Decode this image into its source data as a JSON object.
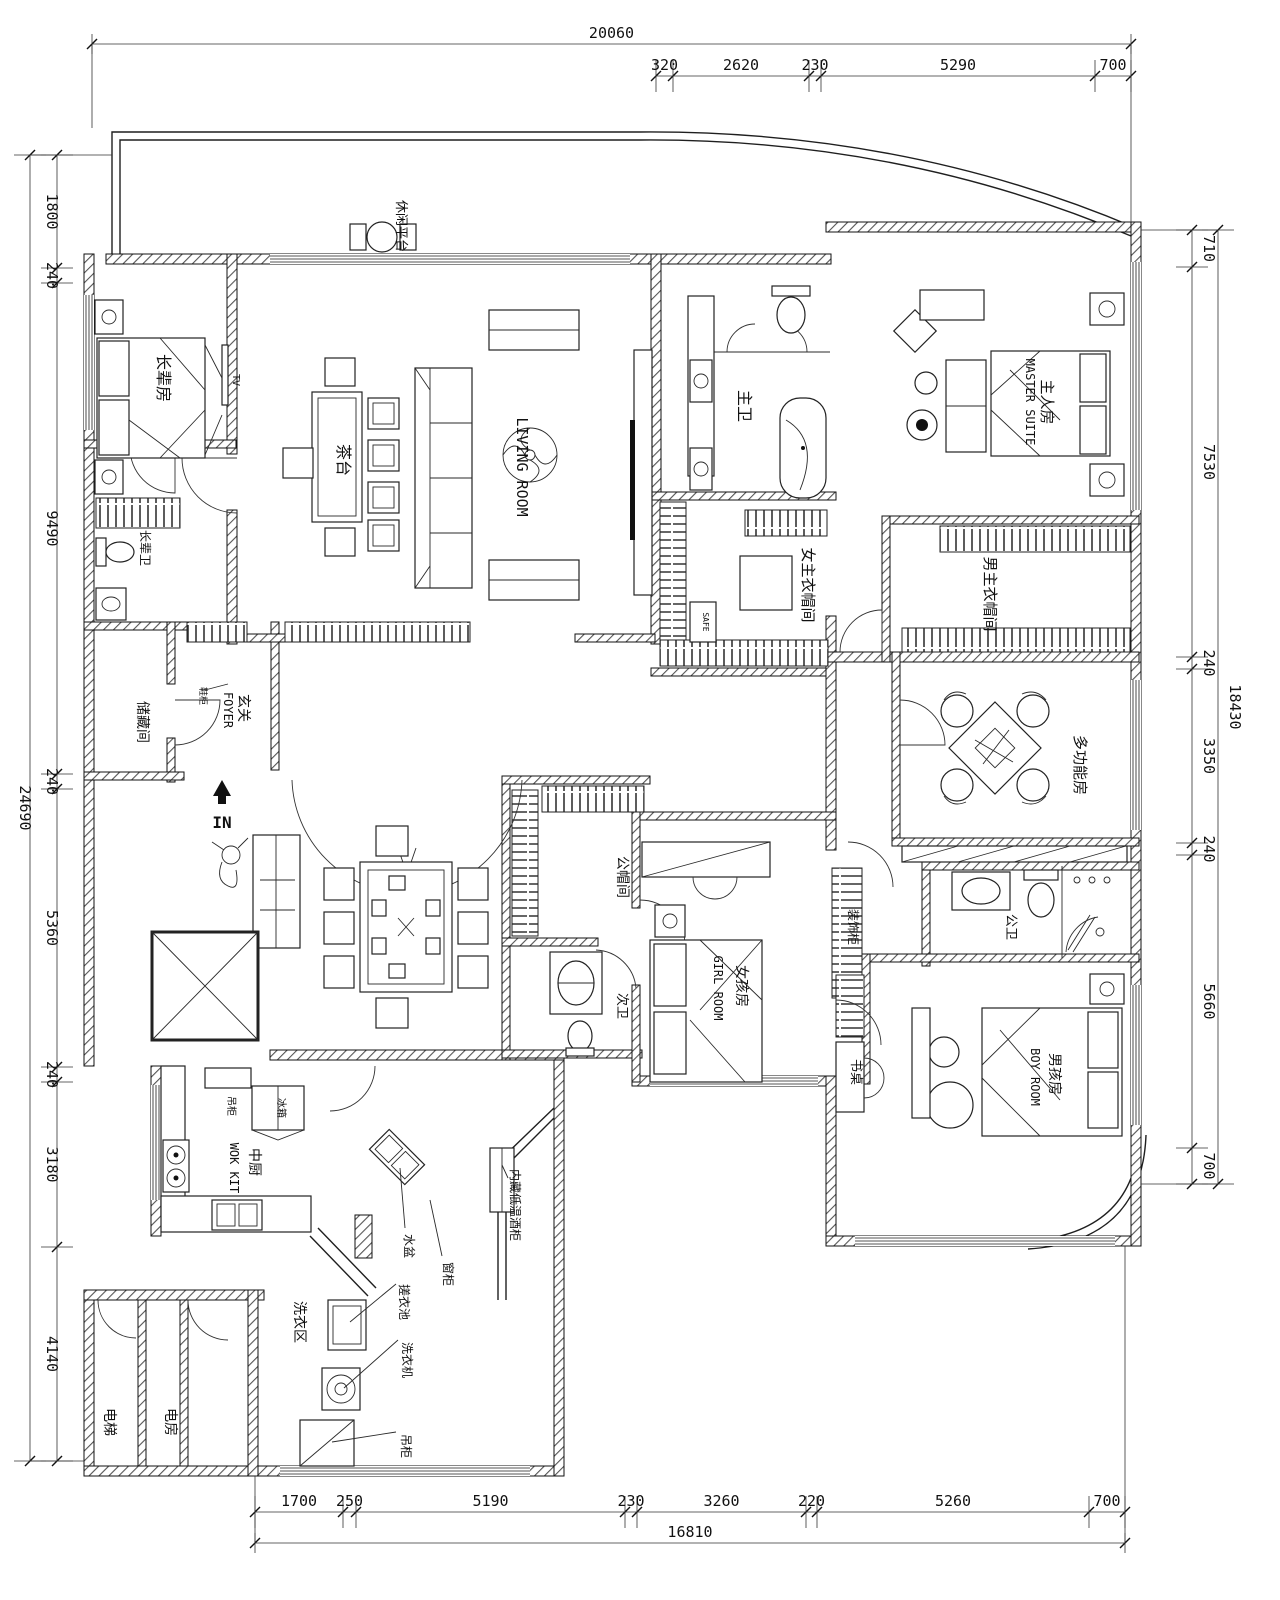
{
  "drawing": {
    "type": "residential-floor-plan"
  },
  "dimensions": {
    "top": {
      "overall": "20060",
      "segments": [
        "320",
        "2620",
        "230",
        "5290",
        "700"
      ]
    },
    "bottom": {
      "overall": "16810",
      "segments": [
        "1700",
        "250",
        "5190",
        "230",
        "3260",
        "220",
        "5260",
        "700"
      ]
    },
    "left": {
      "overall": "24690",
      "segments": [
        "1800",
        "240",
        "9490",
        "240",
        "5360",
        "240",
        "3180",
        "4140"
      ]
    },
    "right": {
      "overall": "18430",
      "segments": [
        "710",
        "7530",
        "240",
        "3350",
        "240",
        "5660",
        "700"
      ]
    }
  },
  "rooms": {
    "balcony": "休闲平台",
    "elder": "长辈房",
    "elder_bath": "长辈卫",
    "storage": "储藏间",
    "foyer_zh": "玄关",
    "foyer_en": "FOYER",
    "shoe_cabinet": "鞋柜",
    "living_en": "LIVING ROOM",
    "tea_table": "茶台",
    "master_bath": "主卫",
    "master_zh": "主人房",
    "master_en": "MASTER SUITE",
    "female_closet": "女主衣帽间",
    "male_closet": "男主衣帽间",
    "multi_room": "多功能房",
    "cloak_room": "公帽间",
    "girl_bath": "次卫",
    "girl_zh": "女孩房",
    "girl_en": "GIRL ROOM",
    "public_bath": "公卫",
    "deco_cabinet": "装饰柜",
    "desk": "书桌",
    "boy_zh": "男孩房",
    "boy_en": "BOY ROOM",
    "wok_zh": "中厨",
    "wok_en": "WOK KIT",
    "hanging_cabinet_kitchen": "吊柜",
    "fridge": "冰箱",
    "laundry": "洗衣区",
    "basin": "水盆",
    "window_cabinet": "窗柜",
    "wash_pool": "搓衣池",
    "washer": "洗衣机",
    "hanging_cabinet_laundry": "吊柜",
    "wine_cooler": "内藏低温酒柜",
    "elevator": "电梯",
    "elec_room": "电房"
  },
  "markers": {
    "entry": "IN",
    "tv": "TV",
    "safe": "SAFE"
  }
}
